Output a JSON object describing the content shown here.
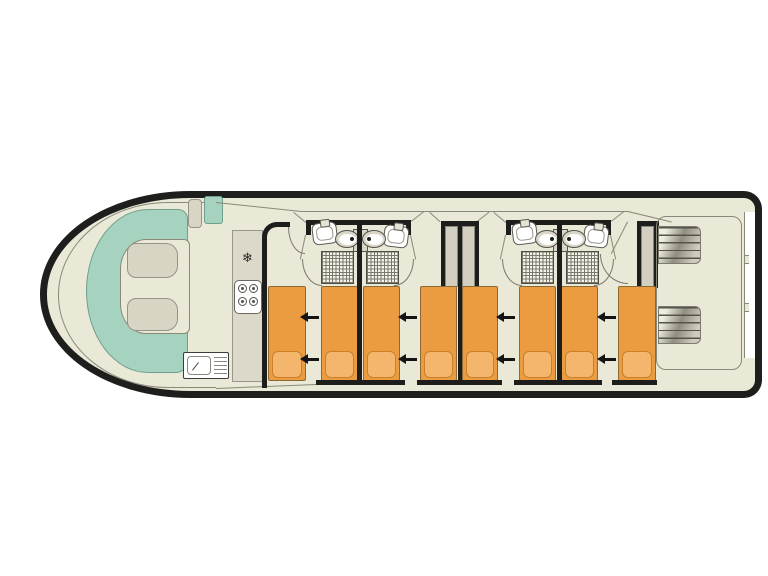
{
  "canvas": {
    "width": 768,
    "height": 576,
    "background": "#ffffff"
  },
  "floorplan": {
    "type": "boat-deck-plan",
    "orientation": "bow-left-stern-right",
    "areas": {
      "bow_lounge": "u-shaped-bench-with-two-tables",
      "galley": "fridge-stove-sink-counter",
      "cabins": [
        "cabin-1-two-single-beds",
        "cabin-2-two-single-beds",
        "cabin-3-two-single-beds",
        "cabin-4-two-single-beds"
      ],
      "bathrooms": [
        "ensuite-cabin-1",
        "ensuite-cabin-2",
        "ensuite-cabin-3",
        "ensuite-cabin-4"
      ],
      "stern_deck": "aft-deck-with-two-step-units"
    },
    "glyphs": {
      "fridge": "❄"
    },
    "colors": {
      "hull": "#1e1e1c",
      "interior": "#eae8d6",
      "teal": "#a5d3bf",
      "cushion": "#d8d5c5",
      "galley": "#dcd9ca",
      "bed": "#eb9c41",
      "pillow": "#f3b66c",
      "pillowb": "#c8802a",
      "wallc": "#1d1d1b",
      "thin": "#8a8878",
      "fixgray": "#d9d6c8",
      "wardrobe": "#d2cfc1"
    },
    "elements": [
      {
        "n": "hull",
        "c": "hull",
        "x": 40,
        "y": 191,
        "w": 722,
        "h": 207
      },
      {
        "n": "bow-bulwark-line",
        "c": "bowarc",
        "x": 58,
        "y": 202,
        "w": 158,
        "h": 186
      },
      {
        "n": "bow-bench-seat",
        "c": "bench",
        "x": 86,
        "y": 209,
        "w": 102,
        "h": 164
      },
      {
        "n": "bow-floor",
        "c": "bowfloor",
        "x": 120,
        "y": 239,
        "w": 70,
        "h": 95
      },
      {
        "n": "bow-table-upper",
        "c": "cushion",
        "x": 127,
        "y": 243,
        "w": 51,
        "h": 35
      },
      {
        "n": "bow-table-lower",
        "c": "cushion",
        "x": 127,
        "y": 298,
        "w": 51,
        "h": 33
      },
      {
        "n": "helm-seat",
        "c": "helm-beige",
        "x": 188,
        "y": 199,
        "w": 14,
        "h": 29
      },
      {
        "n": "helm-console",
        "c": "helm-teal",
        "x": 204,
        "y": 196,
        "w": 19,
        "h": 28
      },
      {
        "n": "roofline-bow",
        "c": "tline",
        "x": 216,
        "y": 202,
        "w": 86,
        "r": 6
      },
      {
        "n": "roofline-mid",
        "c": "tline",
        "x": 301,
        "y": 211,
        "w": 327
      },
      {
        "n": "roofline-stern",
        "c": "tline",
        "x": 628,
        "y": 211,
        "w": 45,
        "r": 13.5
      },
      {
        "n": "deckline-bottom",
        "c": "tline",
        "x": 216,
        "y": 388,
        "w": 100,
        "r": -2.3
      },
      {
        "n": "galley-counter",
        "c": "galley",
        "x": 232,
        "y": 230,
        "w": 31,
        "h": 152
      },
      {
        "n": "fridge-icon",
        "c": "snow",
        "x": 233,
        "y": 250,
        "w": 29,
        "h": 18,
        "t": "❄"
      },
      {
        "n": "stove",
        "c": "stove",
        "x": 234,
        "y": 280,
        "w": 28,
        "h": 34
      },
      {
        "n": "stove-burner-1",
        "c": "burner",
        "x": 238,
        "y": 284,
        "w": 9,
        "h": 9
      },
      {
        "n": "stove-burner-2",
        "c": "burner",
        "x": 249,
        "y": 284,
        "w": 9,
        "h": 9
      },
      {
        "n": "stove-burner-3",
        "c": "burner",
        "x": 238,
        "y": 297,
        "w": 9,
        "h": 9
      },
      {
        "n": "stove-burner-4",
        "c": "burner",
        "x": 249,
        "y": 297,
        "w": 9,
        "h": 9
      },
      {
        "n": "galley-sink-unit",
        "c": "sinkunit",
        "x": 183,
        "y": 352,
        "w": 46,
        "h": 27
      },
      {
        "n": "galley-sink-bowl",
        "c": "sinkbowl",
        "x": 187,
        "y": 356,
        "w": 24,
        "h": 19
      },
      {
        "n": "galley-faucet",
        "c": "tdark",
        "x": 192,
        "y": 370,
        "w": 10,
        "r": -52
      },
      {
        "n": "galley-drainer",
        "c": "drainer",
        "x": 214,
        "y": 357,
        "w": 13,
        "h": 18
      },
      {
        "n": "bath1-wall-top",
        "c": "wall",
        "x": 306,
        "y": 220,
        "w": 105,
        "h": 5
      },
      {
        "n": "bath1-stub-left",
        "c": "wall",
        "x": 306,
        "y": 220,
        "w": 5,
        "h": 15
      },
      {
        "n": "bath1-stub-right",
        "c": "wall",
        "x": 406,
        "y": 220,
        "w": 5,
        "h": 15
      },
      {
        "n": "bath1-door-left",
        "c": "tline",
        "x": 306,
        "y": 235,
        "w": 25,
        "r": 102
      },
      {
        "n": "bath1-door-right",
        "c": "tline",
        "x": 411,
        "y": 235,
        "w": 25,
        "r": 78
      },
      {
        "n": "bath1-door-arc-left",
        "c": "arc-bl",
        "x": 302,
        "y": 259,
        "w": 20,
        "h": 27
      },
      {
        "n": "bath1-door-arc-right",
        "c": "arc-br",
        "x": 394,
        "y": 259,
        "w": 20,
        "h": 27
      },
      {
        "n": "shower-cabin1",
        "c": "shower",
        "x": 321,
        "y": 251,
        "w": 33,
        "h": 33
      },
      {
        "n": "shower-cabin2",
        "c": "shower",
        "x": 366,
        "y": 251,
        "w": 33,
        "h": 33
      },
      {
        "n": "washbasin-cabin1",
        "c": "sink",
        "x": 311,
        "y": 224,
        "w": 25,
        "h": 22,
        "r": -7
      },
      {
        "n": "washbasin-cabin2",
        "c": "sink",
        "x": 385,
        "y": 224,
        "w": 25,
        "h": 22,
        "r": 7
      },
      {
        "n": "bath1-cistern",
        "c": "tank",
        "x": 353,
        "y": 229,
        "w": 15,
        "h": 23
      },
      {
        "n": "toilet-cabin1",
        "c": "toilet tl",
        "x": 335,
        "y": 230,
        "w": 24,
        "h": 18
      },
      {
        "n": "toilet-cabin2",
        "c": "toilet tr",
        "x": 362,
        "y": 230,
        "w": 24,
        "h": 18
      },
      {
        "n": "bath2-wall-top",
        "c": "wall",
        "x": 506,
        "y": 220,
        "w": 105,
        "h": 5
      },
      {
        "n": "bath2-stub-left",
        "c": "wall",
        "x": 506,
        "y": 220,
        "w": 5,
        "h": 15
      },
      {
        "n": "bath2-stub-right",
        "c": "wall",
        "x": 606,
        "y": 220,
        "w": 5,
        "h": 15
      },
      {
        "n": "bath2-door-left",
        "c": "tline",
        "x": 506,
        "y": 235,
        "w": 25,
        "r": 102
      },
      {
        "n": "bath2-door-right",
        "c": "tline",
        "x": 611,
        "y": 235,
        "w": 25,
        "r": 78
      },
      {
        "n": "bath2-door-arc-left",
        "c": "arc-bl",
        "x": 502,
        "y": 259,
        "w": 20,
        "h": 27
      },
      {
        "n": "bath2-door-arc-right",
        "c": "arc-br",
        "x": 594,
        "y": 259,
        "w": 20,
        "h": 27
      },
      {
        "n": "shower-cabin3",
        "c": "shower",
        "x": 521,
        "y": 251,
        "w": 33,
        "h": 33
      },
      {
        "n": "shower-cabin4",
        "c": "shower",
        "x": 566,
        "y": 251,
        "w": 33,
        "h": 33
      },
      {
        "n": "washbasin-cabin3",
        "c": "sink",
        "x": 511,
        "y": 224,
        "w": 25,
        "h": 22,
        "r": -7
      },
      {
        "n": "washbasin-cabin4",
        "c": "sink",
        "x": 585,
        "y": 224,
        "w": 25,
        "h": 22,
        "r": 7
      },
      {
        "n": "bath2-cistern",
        "c": "tank",
        "x": 553,
        "y": 229,
        "w": 15,
        "h": 23
      },
      {
        "n": "toilet-cabin3",
        "c": "toilet tl",
        "x": 535,
        "y": 230,
        "w": 24,
        "h": 18
      },
      {
        "n": "toilet-cabin4",
        "c": "toilet tr",
        "x": 562,
        "y": 230,
        "w": 24,
        "h": 18
      },
      {
        "n": "roof-tie-1",
        "c": "tline",
        "x": 294,
        "y": 212,
        "w": 16,
        "r": 40
      },
      {
        "n": "roof-tie-2",
        "c": "tline",
        "x": 411,
        "y": 221,
        "w": 16,
        "r": -38
      },
      {
        "n": "roof-tie-3",
        "c": "tline",
        "x": 430,
        "y": 212,
        "w": 14,
        "r": 42
      },
      {
        "n": "roof-tie-4",
        "c": "tline",
        "x": 477,
        "y": 221,
        "w": 15,
        "r": -38
      },
      {
        "n": "roof-tie-5",
        "c": "tline",
        "x": 494,
        "y": 212,
        "w": 16,
        "r": 40
      },
      {
        "n": "roof-tie-6",
        "c": "tline",
        "x": 611,
        "y": 221,
        "w": 16,
        "r": -38
      },
      {
        "n": "wardrobe-mid-cap",
        "c": "wall",
        "x": 441,
        "y": 221,
        "w": 38,
        "h": 5
      },
      {
        "n": "wardrobe-mid-wall-left",
        "c": "wall",
        "x": 441,
        "y": 221,
        "w": 4,
        "h": 66
      },
      {
        "n": "wardrobe-mid-wall-right",
        "c": "wall",
        "x": 475,
        "y": 221,
        "w": 4,
        "h": 66
      },
      {
        "n": "wardrobe-cabin2",
        "c": "wbody",
        "x": 445,
        "y": 226,
        "w": 13,
        "h": 61
      },
      {
        "n": "wardrobe-cabin3",
        "c": "wbody",
        "x": 462,
        "y": 226,
        "w": 13,
        "h": 61
      },
      {
        "n": "wardrobe-stern-cap",
        "c": "wall",
        "x": 637,
        "y": 221,
        "w": 22,
        "h": 5
      },
      {
        "n": "wardrobe-stern-wall-left",
        "c": "wall",
        "x": 637,
        "y": 221,
        "w": 4,
        "h": 67
      },
      {
        "n": "wardrobe-cabin4",
        "c": "wbody",
        "x": 641,
        "y": 226,
        "w": 13,
        "h": 62
      },
      {
        "n": "wardrobe-stern-wall-right",
        "c": "wall",
        "x": 654,
        "y": 221,
        "w": 4,
        "h": 67
      },
      {
        "n": "stern-deck-outline",
        "c": "deckline",
        "x": 656,
        "y": 216,
        "w": 86,
        "h": 154
      },
      {
        "n": "stern-steps-top",
        "c": "stairs",
        "x": 658,
        "y": 226,
        "w": 43,
        "h": 38
      },
      {
        "n": "stern-steps-bottom",
        "c": "stairs",
        "x": 658,
        "y": 306,
        "w": 43,
        "h": 38
      },
      {
        "n": "stern-gunwale-inset",
        "c": "inset",
        "x": 744,
        "y": 212,
        "w": 11,
        "h": 146
      },
      {
        "n": "stern-cleat-top",
        "c": "tab",
        "x": 744,
        "y": 255,
        "w": 5,
        "h": 9
      },
      {
        "n": "stern-cleat-bottom",
        "c": "tab",
        "x": 744,
        "y": 303,
        "w": 5,
        "h": 9
      },
      {
        "n": "stern-door-line",
        "c": "tline",
        "x": 628,
        "y": 222,
        "w": 36,
        "r": 117
      },
      {
        "n": "stern-door-arc",
        "c": "arc-bl",
        "x": 600,
        "y": 254,
        "w": 28,
        "h": 30
      },
      {
        "n": "cabin1-door-arc",
        "c": "arc-bl",
        "x": 288,
        "y": 227,
        "w": 17,
        "h": 27
      },
      {
        "n": "bed-1",
        "c": "bed",
        "x": 268,
        "y": 286,
        "w": 38,
        "h": 95
      },
      {
        "n": "bed-2",
        "c": "bed",
        "x": 321,
        "y": 286,
        "w": 37,
        "h": 95
      },
      {
        "n": "bed-3",
        "c": "bed",
        "x": 363,
        "y": 286,
        "w": 37,
        "h": 95
      },
      {
        "n": "bed-4",
        "c": "bed",
        "x": 420,
        "y": 286,
        "w": 37,
        "h": 95
      },
      {
        "n": "bed-5",
        "c": "bed",
        "x": 462,
        "y": 286,
        "w": 36,
        "h": 95
      },
      {
        "n": "bed-6",
        "c": "bed",
        "x": 519,
        "y": 286,
        "w": 37,
        "h": 95
      },
      {
        "n": "bed-7",
        "c": "bed",
        "x": 561,
        "y": 286,
        "w": 37,
        "h": 95
      },
      {
        "n": "bed-8",
        "c": "bed",
        "x": 618,
        "y": 286,
        "w": 38,
        "h": 95
      },
      {
        "n": "pillow-1",
        "c": "pillow",
        "x": 272,
        "y": 351,
        "w": 30,
        "h": 27
      },
      {
        "n": "pillow-2",
        "c": "pillow",
        "x": 325,
        "y": 351,
        "w": 29,
        "h": 27
      },
      {
        "n": "pillow-3",
        "c": "pillow",
        "x": 367,
        "y": 351,
        "w": 29,
        "h": 27
      },
      {
        "n": "pillow-4",
        "c": "pillow",
        "x": 424,
        "y": 351,
        "w": 29,
        "h": 27
      },
      {
        "n": "pillow-5",
        "c": "pillow",
        "x": 466,
        "y": 351,
        "w": 28,
        "h": 27
      },
      {
        "n": "pillow-6",
        "c": "pillow",
        "x": 523,
        "y": 351,
        "w": 29,
        "h": 27
      },
      {
        "n": "pillow-7",
        "c": "pillow",
        "x": 565,
        "y": 351,
        "w": 29,
        "h": 27
      },
      {
        "n": "pillow-8",
        "c": "pillow",
        "x": 622,
        "y": 351,
        "w": 30,
        "h": 27
      },
      {
        "n": "cabin-wall-1",
        "c": "wall",
        "x": 357,
        "y": 220,
        "w": 5,
        "h": 163
      },
      {
        "n": "cabin-wall-2",
        "c": "wall",
        "x": 458,
        "y": 221,
        "w": 4,
        "h": 162
      },
      {
        "n": "cabin-wall-3",
        "c": "wall",
        "x": 557,
        "y": 220,
        "w": 5,
        "h": 163
      },
      {
        "n": "corridor-wall",
        "c": "lwall",
        "x": 262,
        "y": 222,
        "w": 28,
        "h": 166
      },
      {
        "n": "bottom-wall-1",
        "c": "wall",
        "x": 316,
        "y": 380,
        "w": 89,
        "h": 5
      },
      {
        "n": "bottom-wall-2",
        "c": "wall",
        "x": 417,
        "y": 380,
        "w": 85,
        "h": 5
      },
      {
        "n": "bottom-wall-3",
        "c": "wall",
        "x": 514,
        "y": 380,
        "w": 88,
        "h": 5
      },
      {
        "n": "bottom-wall-4",
        "c": "wall",
        "x": 612,
        "y": 380,
        "w": 45,
        "h": 5
      },
      {
        "n": "bed-slide-arrow-1",
        "c": "arrow",
        "x": 308,
        "y": 316,
        "w": 11,
        "h": 2.5
      },
      {
        "n": "bed-slide-arrow-2",
        "c": "arrow",
        "x": 308,
        "y": 358,
        "w": 11,
        "h": 2.5
      },
      {
        "n": "bed-slide-arrow-3",
        "c": "arrow",
        "x": 406,
        "y": 316,
        "w": 11,
        "h": 2.5
      },
      {
        "n": "bed-slide-arrow-4",
        "c": "arrow",
        "x": 406,
        "y": 358,
        "w": 11,
        "h": 2.5
      },
      {
        "n": "bed-slide-arrow-5",
        "c": "arrow",
        "x": 504,
        "y": 316,
        "w": 11,
        "h": 2.5
      },
      {
        "n": "bed-slide-arrow-6",
        "c": "arrow",
        "x": 504,
        "y": 358,
        "w": 11,
        "h": 2.5
      },
      {
        "n": "bed-slide-arrow-7",
        "c": "arrow",
        "x": 605,
        "y": 316,
        "w": 11,
        "h": 2.5
      },
      {
        "n": "bed-slide-arrow-8",
        "c": "arrow",
        "x": 605,
        "y": 358,
        "w": 11,
        "h": 2.5
      }
    ]
  }
}
